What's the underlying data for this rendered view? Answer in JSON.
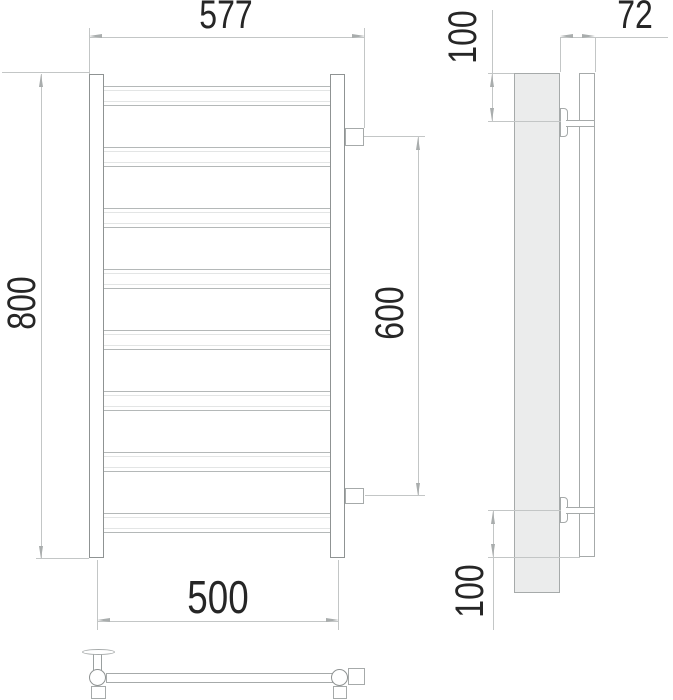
{
  "drawing": {
    "type": "technical-drawing-three-views",
    "front_view": {
      "rung_count": 8,
      "collector_count": 2,
      "connection_count": 2
    },
    "colors": {
      "object_line": "#8f9393",
      "rung_line": "#b4b8b8",
      "dimension_line": "#c3c6c6",
      "arrow": "#a9adad",
      "wall_panel_fill": "#ebecec",
      "text": "#262626",
      "background": "#ffffff"
    }
  },
  "dims": {
    "overall_width": "577",
    "overall_height": "800",
    "axis_width": "500",
    "connection_spacing": "600",
    "wall_depth": "72",
    "top_offset": "100",
    "bottom_offset": "100"
  }
}
